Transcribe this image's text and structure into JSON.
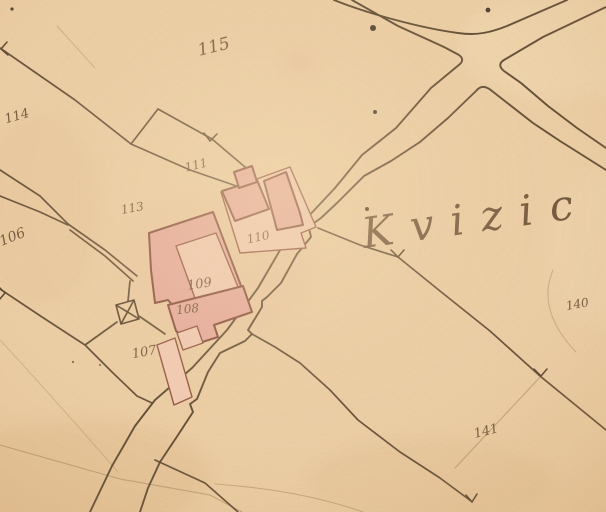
{
  "map": {
    "place_label": "Kvizic",
    "parcels": [
      {
        "label": "115"
      },
      {
        "label": "114"
      },
      {
        "label": "111"
      },
      {
        "label": "113"
      },
      {
        "label": "106"
      },
      {
        "label": "110"
      },
      {
        "label": "109"
      },
      {
        "label": "108"
      },
      {
        "label": "107"
      },
      {
        "label": "140"
      },
      {
        "label": "141"
      }
    ],
    "symbols": [
      {
        "name": "chapel-cross-icon",
        "meaning": "small building with X cross"
      },
      {
        "name": "boundary-tick-icon",
        "meaning": "surveyor arrow tick on boundary line"
      },
      {
        "name": "ink-dot",
        "meaning": "ink spot on paper"
      }
    ],
    "colors": {
      "paper": "#ebcda4",
      "paper_shade": "#c69a63",
      "ink": "#4f3b26",
      "handwriting": "#5d432a",
      "building_dark": "#e5a69c",
      "building_light": "#f2c9b4",
      "building_outline": "#7c4033"
    }
  }
}
